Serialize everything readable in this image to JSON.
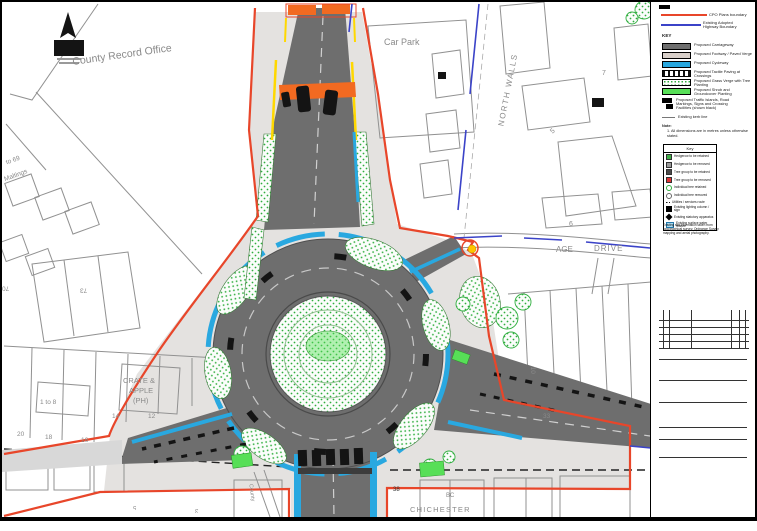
{
  "map": {
    "labels": {
      "county_record_office": "County Record Office",
      "car_park": "Car Park",
      "north_walls": "NORTH WALLS",
      "age_fragment": "AGE",
      "drive": "DRIVE",
      "no6": "6",
      "to69": "to 69",
      "maltings": "Maltings",
      "no73": "73",
      "no70": "70",
      "crate_line1": "CRATE &",
      "crate_line2": "APPLE",
      "crate_line3": "(PH)",
      "one_to_8": "1 to 8",
      "no14": "14",
      "no12": "12",
      "no20": "20",
      "no18": "18",
      "no16": "16",
      "no33": "33",
      "no10": "10",
      "no38": "38",
      "chichester": "CHICHESTER",
      "bc": "BC",
      "county_street": "County",
      "no7": "7",
      "no5": "5",
      "no5b": "5",
      "no3": "3"
    }
  },
  "legend": {
    "boundary_lines": [
      {
        "label": "CPO Plans boundary",
        "color": "#e8462a"
      },
      {
        "label": "Existing Adopted Highway Boundary",
        "color": "#3b43c8"
      }
    ],
    "key_title": "KEY",
    "items": [
      {
        "label": "Proposed Carriageway"
      },
      {
        "label": "Proposed Footway / Paved Verge"
      },
      {
        "label": "Proposed Cycleway"
      },
      {
        "label": "Proposed Tactile Paving at Crossings"
      },
      {
        "label": "Proposed Grass Verge with Tree Planting"
      },
      {
        "label": "Proposed Shrub and Groundcover Planting"
      }
    ],
    "symbol_item": {
      "label": "Proposed Traffic Islands, Road Markings, Signs and Crossing Facilities (shown black)"
    },
    "kerb_item": {
      "label": "Existing kerb line"
    },
    "note_title": "Note:",
    "note_1": "1. All dimensions are in metres unless otherwise stated."
  },
  "tree_key": {
    "title": "Key",
    "items": [
      {
        "label": "Hedgerow to be retained"
      },
      {
        "label": "Hedgerow to be removed"
      },
      {
        "label": "Tree group to be retained"
      },
      {
        "label": "Tree group to be removed"
      },
      {
        "label": "Individual tree retained"
      },
      {
        "label": "Individual tree removed"
      },
      {
        "label": "Utilities / services route"
      },
      {
        "label": "Existing lighting column / sign"
      },
      {
        "label": "Existing statutory apparatus"
      },
      {
        "label": "Existing surface water feature"
      }
    ],
    "footnote": "Existing site information taken from topographical survey, Ordnance Survey mapping and aerial photography."
  },
  "colors": {
    "boundary_red": "#e8462a",
    "highway_blue": "#3b43c8",
    "carriageway_gray": "#6e6e6e",
    "cycleway_cyan": "#29a8e0",
    "planting_green": "#2fae3e",
    "shrub_green": "#57df57",
    "crossing_orange": "#f26a21",
    "marking_yellow": "#ffd800"
  }
}
